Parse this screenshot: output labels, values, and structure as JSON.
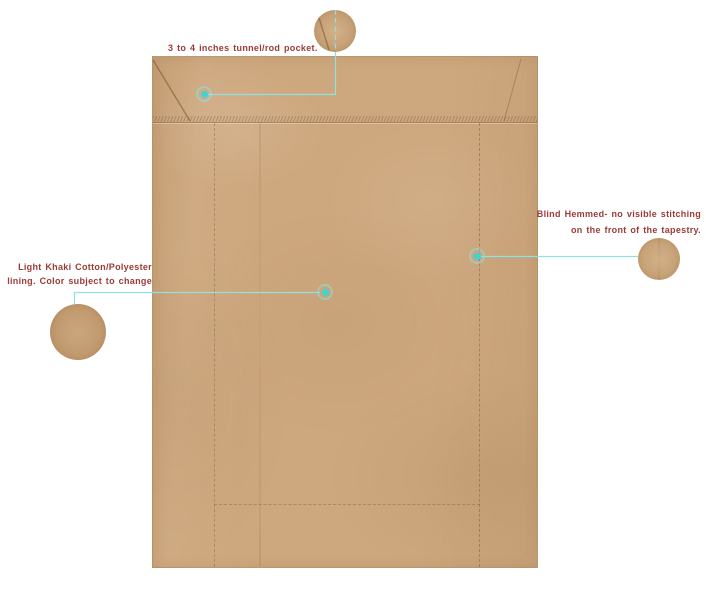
{
  "image": {
    "kind": "annotated product detail view",
    "subject": "tapestry back with lining, rod pocket and hems"
  },
  "callouts": {
    "rod_pocket": {
      "label": "3 to 4 inches tunnel/rod pocket."
    },
    "lining": {
      "line1": "Light Khaki Cotton/Polyester",
      "line2": "lining. Color subject to change"
    },
    "blind_hem": {
      "line1": "Blind Hemmed- no visible stitching",
      "line2": "on the front of the tapestry."
    }
  },
  "colors": {
    "accent_line": "#8fe2e2",
    "dot_fill": "#3fd4d4",
    "label_text": "#9a3b38",
    "fabric_base": "#cda77d",
    "fabric_swatch": "#c79f73",
    "background": "#ffffff"
  }
}
